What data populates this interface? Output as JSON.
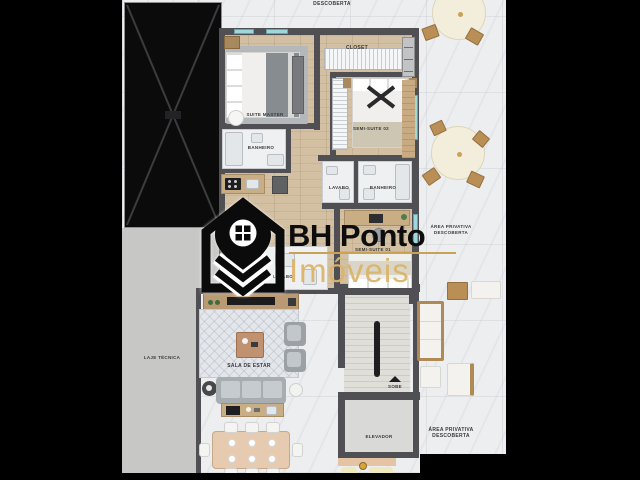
{
  "watermark": {
    "brand": "BH Ponto",
    "sub": "Imóveis",
    "accent": "#c9a256",
    "brand_color": "#0d0d0e",
    "icon": "house-location-pin-with-chevrons"
  },
  "labels": {
    "descoberta": "DESCOBERTA",
    "area_privativa": "ÁREA PRIVATIVA",
    "closet": "CLOSET",
    "suite_master": "SUITE MASTER",
    "semi_suite_02": "SEMI-SUITE 02",
    "semi_suite_01": "SEMI-SUITE 01",
    "banheiro": "BANHEIRO",
    "lavabo": "LAVABO",
    "laje_tecnica": "LAJE TÉCNICA",
    "sala_de_estar": "SALA DE ESTAR",
    "sobe": "SOBE",
    "elevador": "ELEVADOR"
  },
  "colors": {
    "wall": "#505054",
    "wood_floor": "#d3bfa2",
    "marble_floor": "#edeef0",
    "window_glass": "#9fd8dc",
    "background": "#000000"
  }
}
